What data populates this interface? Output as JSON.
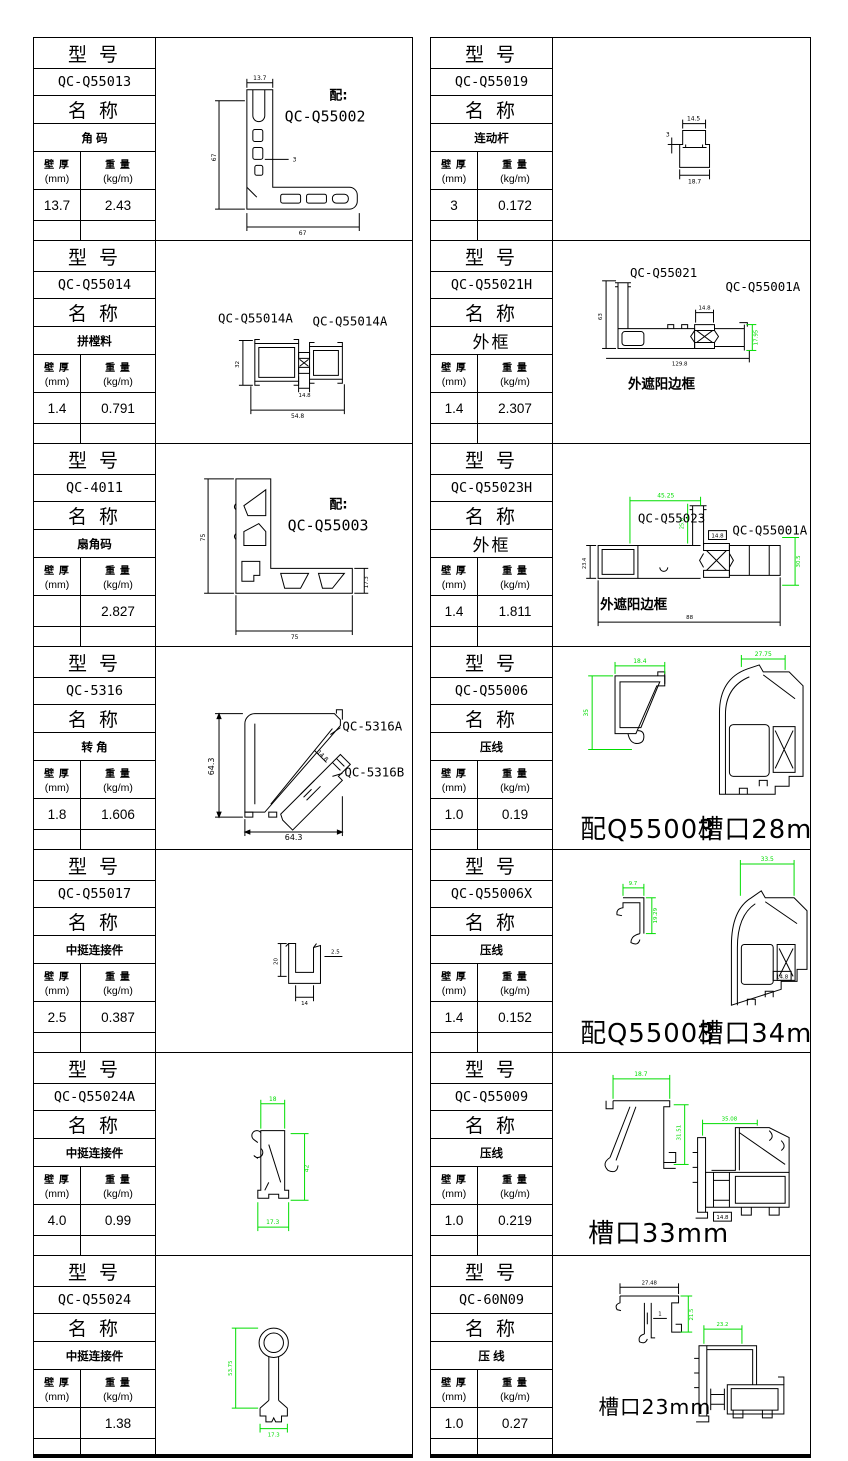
{
  "page": {
    "bg": "#ffffff",
    "line": "#000000",
    "dim_green": "#00dd00"
  },
  "labels": {
    "model_header": "型 号",
    "name_header": "名 称",
    "thickness_title": "壁 厚",
    "thickness_unit": "(mm)",
    "weight_title": "重 量",
    "weight_unit": "(kg/m)"
  },
  "cells": [
    {
      "model": "QC-Q55013",
      "name": "角 码",
      "thickness": "13.7",
      "weight": "2.43",
      "drawing": {
        "mate_prefix": "配:",
        "mate": "QC-Q55002",
        "dim_top": "13.7",
        "dim_left": "67",
        "dim_bottom": "67",
        "dim_wall": "3"
      }
    },
    {
      "model": "QC-Q55014",
      "name": "拼樘料",
      "thickness": "1.4",
      "weight": "0.791",
      "drawing": {
        "label_a": "QC-Q55014A",
        "label_b": "QC-Q55014A",
        "dim_left": "32",
        "dim_mid": "14.8",
        "dim_bottom": "54.8"
      }
    },
    {
      "model": "QC-4011",
      "name": "扇角码",
      "thickness": "",
      "weight": "2.827",
      "drawing": {
        "mate_prefix": "配:",
        "mate": "QC-Q55003",
        "dim_left": "75",
        "dim_bottom": "75",
        "dim_right": "17.3"
      }
    },
    {
      "model": "QC-5316",
      "name": "转 角",
      "thickness": "1.8",
      "weight": "1.606",
      "drawing": {
        "label_a": "QC-5316A",
        "label_b": "QC-5316B",
        "dim_left": "64.3",
        "dim_bottom": "64.3",
        "dim_diag": "14.8"
      }
    },
    {
      "model": "QC-Q55017",
      "name": "中挺连接件",
      "thickness": "2.5",
      "weight": "0.387",
      "drawing": {
        "dim_left": "20",
        "dim_right": "2.5",
        "dim_bottom": "14"
      }
    },
    {
      "model": "QC-Q55024A",
      "name": "中挺连接件",
      "thickness": "4.0",
      "weight": "0.99",
      "drawing": {
        "dim_top": "18",
        "dim_right": "42",
        "dim_bottom": "17.3"
      }
    },
    {
      "model": "QC-Q55024",
      "name": "中挺连接件",
      "thickness": "",
      "weight": "1.38",
      "drawing": {
        "dim_left": "53.75",
        "dim_bottom": "17.3"
      }
    },
    {
      "model": "QC-Q55019",
      "name": "连动杆",
      "thickness": "3",
      "weight": "0.172",
      "drawing": {
        "dim_top": "14.5",
        "dim_left": "3",
        "dim_bottom": "18.7"
      }
    },
    {
      "model": "QC-Q55021H",
      "name": "外框",
      "thickness": "1.4",
      "weight": "2.307",
      "drawing": {
        "label_a": "QC-Q55021",
        "label_b": "QC-Q55001A",
        "caption": "外遮阳边框",
        "dim_left": "63",
        "dim_mid": "14.8",
        "dim_right": "17.95",
        "dim_bottom": "129.8"
      }
    },
    {
      "model": "QC-Q55023H",
      "name": "外框",
      "thickness": "1.4",
      "weight": "1.811",
      "drawing": {
        "label_a": "QC-Q55023",
        "label_b": "QC-Q55001A",
        "caption": "外遮阳边框",
        "dim_top": "45.25",
        "dim_sub": "25.6",
        "dim_left": "23.4",
        "dim_mid": "14.8",
        "dim_right": "30.5",
        "dim_bottom": "88"
      }
    },
    {
      "model": "QC-Q55006",
      "name": "压线",
      "thickness": "1.0",
      "weight": "0.19",
      "drawing": {
        "caption_a": "配Q55003",
        "caption_b": "槽口28mm",
        "dim_a_top": "18.4",
        "dim_a_left": "35",
        "dim_b_top": "27.75"
      }
    },
    {
      "model": "QC-Q55006X",
      "name": "压线",
      "thickness": "1.4",
      "weight": "0.152",
      "drawing": {
        "caption_a": "配Q55003",
        "caption_b": "槽口34mm",
        "dim_a_top": "9.7",
        "dim_a_right": "19.29",
        "dim_b_top": "33.5",
        "dim_b_small": "14.8"
      }
    },
    {
      "model": "QC-Q55009",
      "name": "压线",
      "thickness": "1.0",
      "weight": "0.219",
      "drawing": {
        "caption": "槽口33mm",
        "dim_a_top": "18.7",
        "dim_a_right": "31.51",
        "dim_b_top": "35.08",
        "dim_b_small": "14.8"
      }
    },
    {
      "model": "QC-60N09",
      "name": "压 线",
      "thickness": "1.0",
      "weight": "0.27",
      "drawing": {
        "caption": "槽口23mm",
        "dim_a_top": "27.48",
        "dim_a_wall": "1",
        "dim_a_right": "21.5",
        "dim_b_top": "23.2"
      }
    }
  ]
}
